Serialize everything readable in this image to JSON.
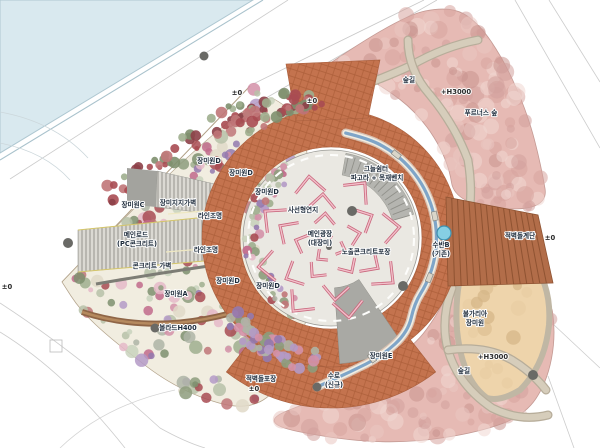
{
  "plan_type": "landscape-site-plan",
  "labels": [
    {
      "text": "±0",
      "x": 237,
      "y": 95,
      "k": "lv"
    },
    {
      "text": "±0",
      "x": 312,
      "y": 103,
      "k": "lv"
    },
    {
      "text": "숲길",
      "x": 409,
      "y": 82,
      "k": "nm"
    },
    {
      "text": "+H3000",
      "x": 456,
      "y": 94,
      "k": "lv"
    },
    {
      "text": "푸르너스 숲",
      "x": 481,
      "y": 115,
      "k": "nm"
    },
    {
      "text": "그늘쉼터",
      "x": 376,
      "y": 171,
      "k": "nm"
    },
    {
      "text": "파고라 + 목재벤치",
      "x": 377,
      "y": 180,
      "k": "nm"
    },
    {
      "text": "장미원D",
      "x": 209,
      "y": 163,
      "k": "nm"
    },
    {
      "text": "장미원D",
      "x": 241,
      "y": 175,
      "k": "nm"
    },
    {
      "text": "장미원D",
      "x": 267,
      "y": 194,
      "k": "nm"
    },
    {
      "text": "사선형연지",
      "x": 303,
      "y": 212,
      "k": "nm"
    },
    {
      "text": "메인광장",
      "x": 320,
      "y": 236,
      "k": "nm"
    },
    {
      "text": "(대장미)",
      "x": 320,
      "y": 245,
      "k": "nm"
    },
    {
      "text": "노출콘크리트포장",
      "x": 366,
      "y": 254,
      "k": "nm"
    },
    {
      "text": "장미원C",
      "x": 133,
      "y": 207,
      "k": "nm"
    },
    {
      "text": "장미지지가벽",
      "x": 178,
      "y": 205,
      "k": "nm"
    },
    {
      "text": "라인조명",
      "x": 210,
      "y": 218,
      "k": "nm"
    },
    {
      "text": "메인로드",
      "x": 136,
      "y": 237,
      "k": "nm"
    },
    {
      "text": "(PC콘크리트)",
      "x": 137,
      "y": 246,
      "k": "nm"
    },
    {
      "text": "라인조명",
      "x": 206,
      "y": 252,
      "k": "nm"
    },
    {
      "text": "콘크리트 가벽",
      "x": 152,
      "y": 268,
      "k": "nm"
    },
    {
      "text": "장미원A",
      "x": 176,
      "y": 296,
      "k": "nm"
    },
    {
      "text": "장미원D",
      "x": 228,
      "y": 283,
      "k": "nm"
    },
    {
      "text": "장미원D",
      "x": 268,
      "y": 288,
      "k": "nm"
    },
    {
      "text": "볼라드H400",
      "x": 178,
      "y": 330,
      "k": "nm"
    },
    {
      "text": "적벽돌포장",
      "x": 261,
      "y": 381,
      "k": "nm"
    },
    {
      "text": "±0",
      "x": 254,
      "y": 391,
      "k": "lv"
    },
    {
      "text": "수로",
      "x": 334,
      "y": 378,
      "k": "nm"
    },
    {
      "text": "(신규)",
      "x": 334,
      "y": 387,
      "k": "nm"
    },
    {
      "text": "장미원E",
      "x": 381,
      "y": 358,
      "k": "nm"
    },
    {
      "text": "수반B",
      "x": 441,
      "y": 247,
      "k": "nm"
    },
    {
      "text": "(기존)",
      "x": 441,
      "y": 256,
      "k": "nm"
    },
    {
      "text": "적벽돌계단",
      "x": 520,
      "y": 238,
      "k": "nm"
    },
    {
      "text": "±0",
      "x": 550,
      "y": 240,
      "k": "lv"
    },
    {
      "text": "불가리아",
      "x": 475,
      "y": 316,
      "k": "nm"
    },
    {
      "text": "장미원",
      "x": 475,
      "y": 325,
      "k": "nm"
    },
    {
      "text": "+H3000",
      "x": 493,
      "y": 359,
      "k": "lv"
    },
    {
      "text": "숲길",
      "x": 464,
      "y": 373,
      "k": "nm"
    },
    {
      "text": "±0",
      "x": 7,
      "y": 289,
      "k": "lv"
    }
  ],
  "colors": {
    "water": "#d9e9ef",
    "brick_ring": "#c4734e",
    "brick_stairs": "#b26d49",
    "pink_forest": "#e6bab4",
    "plaza": "#eae8e2",
    "beige_garden": "#eed4ab",
    "forest_path": "#d6cdbb",
    "waterway_blue": "#7fa5c8",
    "label_text": "#1c2a3a",
    "basin_blue": "#86cfe4"
  }
}
